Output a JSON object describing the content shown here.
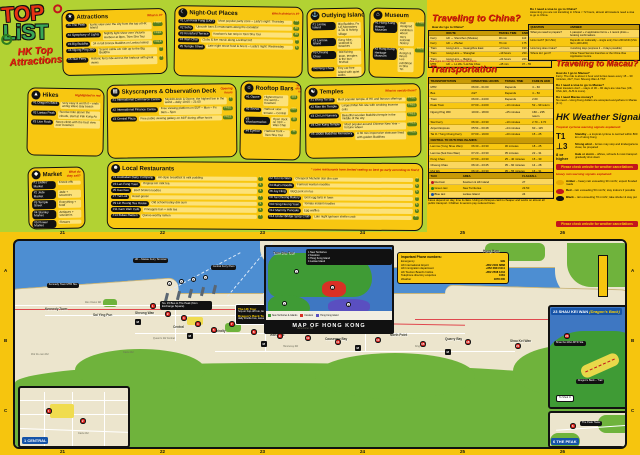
{
  "logo": {
    "line1": "TOP",
    "line2": "LiST",
    "sub1": "HK Top",
    "sub2": "Attractions"
  },
  "categories": [
    {
      "id": "attractions",
      "icon": "★",
      "title": "Attractions",
      "subtitle": "What is it?",
      "items": [
        {
          "name": "The Peak",
          "desc": "Iconic view over the city from the top of HK Island",
          "tag": "FREE"
        },
        {
          "name": "Symphony of Lights",
          "desc": "Nightly light show over Victoria Harbour at 8pm, Tsim Sha Tsui",
          "tag": "FREE"
        },
        {
          "name": "Big Buddha",
          "desc": "34 m tall bronze Buddha on Lantau Island",
          "tag": "FREE"
        },
        {
          "name": "Ngong Ping 360",
          "desc": "Scenic cable car ride up to the Big Buddha",
          "tag": "$"
        },
        {
          "name": "Star Ferry",
          "desc": "Historic ferry ride across the harbour with great views",
          "tag": "$"
        }
      ]
    },
    {
      "id": "nightout",
      "icon": "☾",
      "title": "Night-Out Places",
      "subtitle": "Which district is it?",
      "items": [
        {
          "name": "Lan Kwai Fong (LKF)",
          "desc": "Most popular party zone – Lady's night: Thursday",
          "tag": "$$"
        },
        {
          "name": "Soho",
          "desc": "Upscale bars & restaurants along the escalator",
          "tag": "$$"
        },
        {
          "name": "Knutsford Terrace",
          "desc": "Kowloon's bar strip in Tsim Sha Tsui",
          "tag": "$$"
        },
        {
          "name": "Wan Chai",
          "desc": "Clubs & live music along Lockhart Rd",
          "tag": "$"
        },
        {
          "name": "Temple Street",
          "desc": "Late night street food & beers – Lady's night: Wednesday",
          "tag": "$"
        }
      ]
    },
    {
      "id": "islands",
      "icon": "⚓",
      "title": "Outlying Islands",
      "subtitle": "What to see there?",
      "items": [
        {
          "name": "Lantau Island",
          "desc": "Big Buddha, Po Lin Monastery & Tai O fishing village"
        },
        {
          "name": "Lamma Island",
          "desc": "Easy hike, seafood & beaches"
        },
        {
          "name": "Cheung Chau",
          "desc": "Old fishing town, temples & the bun festival"
        },
        {
          "name": "Peng Chau",
          "desc": "Tiny car-free island with quiet walks"
        }
      ]
    },
    {
      "id": "museum",
      "icon": "⌂",
      "title": "Museum",
      "subtitle": "",
      "items": [
        {
          "name": "Hong Kong History Museum",
          "desc": "Well designed exhibition about HK's colonial history",
          "tag": "FREE on Wed"
        },
        {
          "name": "Hong Kong Heritage Museum",
          "desc": "Art, design & Bruce Lee exhibition in Sha Tin",
          "tag": "FREE on Wed"
        }
      ]
    },
    {
      "id": "hikes",
      "icon": "▲",
      "title": "Hikes",
      "subtitle": "Highlighted in red",
      "items": [
        {
          "name": "Dragon's Back",
          "desc": "Very easy & worth it – ends at Big Wave Bay beach"
        },
        {
          "name": "Lantau Peak",
          "desc": "Sunrise hike above the clouds, start at Pak Kung Au"
        },
        {
          "name": "Lion Rock",
          "desc": "Steep climb with the best view over Kowloon"
        }
      ]
    },
    {
      "id": "sky",
      "icon": "▦",
      "title": "Skyscrapers & Observation Deck",
      "subtitle": "Opening hours",
      "items": [
        {
          "name": "International Commerce Centre",
          "desc": "Sky100 deck & Ozone, the highest bar in the world – daily 10:00 – 21:00",
          "tag": "$"
        },
        {
          "name": "International Finance Centre",
          "desc": "Free viewing platform on 55/F – Mon – Fri 9am – 5pm",
          "tag": "FREE"
        },
        {
          "name": "Central Plaza",
          "desc": "Free public viewing gallery on 46/F during office hours",
          "tag": "FREE"
        }
      ]
    },
    {
      "id": "rooftop",
      "icon": "☼",
      "title": "Rooftop Bars",
      "subtitle": "Which district is it?",
      "items": [
        {
          "name": "Ozone",
          "desc": "Highest bar in the world – Kowloon",
          "tag": "$$$"
        },
        {
          "name": "Sevva",
          "desc": "Harbour view terrace – Central",
          "tag": "$$$"
        },
        {
          "name": "Wooloomooloo",
          "desc": "Open deck on 31/F – Wan Chai",
          "tag": "$$"
        },
        {
          "name": "Eyebar",
          "desc": "Harbour front – Tsim Sha Tsui",
          "tag": "$$"
        }
      ]
    },
    {
      "id": "temples",
      "icon": "☯",
      "title": "Temples",
      "subtitle": "What to see/do there?",
      "items": [
        {
          "name": "Wong Tai Sin",
          "desc": "Most popular temple of HK and famous offerings",
          "tag": "FREE"
        },
        {
          "name": "Man Mo Temple",
          "desc": "Largest Man Mo site with smoking incense coils",
          "tag": "FREE"
        },
        {
          "name": "Chi Lin Nunnery",
          "desc": "Beautiful wooden Buddhist temple in the middle of the city",
          "tag": "FREE"
        },
        {
          "name": "Che Kung Temple",
          "desc": "Most popular around Chinese New Year – fortune wheel",
          "tag": "FREE"
        },
        {
          "name": "10000 Buddhas Monastery",
          "desc": "A 30 min impressive staircase lined with golden Buddhas",
          "tag": "FREE"
        }
      ]
    },
    {
      "id": "market",
      "icon": "◆",
      "title": "Market",
      "subtitle": "What do they sell?",
      "items": [
        {
          "name": "Ladies' Market",
          "desc": "Knock-offs"
        },
        {
          "name": "Jade Market",
          "desc": "Jade + souvenirs"
        },
        {
          "name": "Temple Street",
          "desc": "Everything + food"
        },
        {
          "name": "Stanley Market",
          "desc": "Antiques + souvenirs"
        },
        {
          "name": "Flower Market",
          "desc": "Flowers"
        },
        {
          "name": "Goldfish Market",
          "desc": "Goldfishes + pet stuff"
        }
      ]
    },
    {
      "id": "food",
      "icon": "☻",
      "title": "Local Restaurants",
      "subtitle": "* some restaurants have limited seating so best go early according to find it",
      "two_col": true,
      "items": [
        {
          "name": "Australian Dairy Company",
          "desc": "HK-style breakfast & milk pudding",
          "tag": "$"
        },
        {
          "name": "Tim Ho Wan",
          "desc": "Cheapest Michelin star dim sum",
          "tag": "$"
        },
        {
          "name": "Lan Fong Yuen",
          "desc": "Original HK milk tea",
          "tag": "$"
        },
        {
          "name": "Mak's Noodle",
          "desc": "Famous wonton noodles",
          "tag": "$"
        },
        {
          "name": "Kau Kee",
          "desc": "Beef brisket noodles",
          "tag": "$"
        },
        {
          "name": "Joy Hing",
          "desc": "BBQ pork on rice",
          "tag": "$"
        },
        {
          "name": "Yat Lok",
          "desc": "Roast goose",
          "tag": "$"
        },
        {
          "name": "Tai Cheong Bakery",
          "desc": "Best egg tarts in town",
          "tag": "$"
        },
        {
          "name": "Lin Heung Tea House",
          "desc": "Old school trolley dim sum",
          "tag": "$"
        },
        {
          "name": "Sing Heung Yuen",
          "desc": "Tomato instant noodles",
          "tag": "$"
        },
        {
          "name": "Kam Wah Café",
          "desc": "Pineapple bun + milk tea",
          "tag": "$"
        },
        {
          "name": "Mammy Pancake",
          "desc": "Egg waffles",
          "tag": "$"
        },
        {
          "name": "Butao Ramen",
          "desc": "Queue-worthy ramen",
          "tag": "$"
        },
        {
          "name": "Under Bridge Spicy Crab",
          "desc": "Late night typhoon shelter crab",
          "tag": "$$"
        }
      ]
    }
  ],
  "china": {
    "title": "Traveling to China?",
    "lead": "How do I go to China?",
    "table_headers": [
      "",
      "ROUTE",
      "TRAVEL TIME",
      "FARE IN HKD"
    ],
    "rows": [
      [
        "Ferry",
        "HK ↔ Shenzhen (Shekou)",
        "30 min",
        "110"
      ],
      [
        "Ferry",
        "HK ↔ Zhuhai",
        "70 min",
        "175"
      ],
      [
        "Train",
        "Hung Hom ↔ Guangzhou East",
        "~2 hours",
        "190 – 230"
      ],
      [
        "Train",
        "Hung Hom ↔ Shanghai",
        "~19 hours",
        "230 – 1,039"
      ],
      [
        "Train",
        "Hung Hom ↔ Beijing",
        "~24 hours",
        "240 – 1,191"
      ],
      [
        "MTR",
        "HK ↔ Lo Wu / Lok Ma Chau",
        "~45 min",
        "37 – 55"
      ]
    ],
    "footnote": "* See signs on map for traveling directions",
    "visa_q": "Do I need a visa to go to China?",
    "visa_a": "Assuming you are not transiting in China < 72 hours, almost all travelers need a visa to go to China.",
    "qa_headers": [
      "QUESTION",
      "ANSWER"
    ],
    "qa": [
      [
        "What you need to prepare?",
        "1 passport + 2 application forms + 1 recent photo + booking confirmations"
      ],
      [
        "How much? (for USA)",
        "Depends on nationality – single entry from 200 HKD (USA flat 1,100 HKD)"
      ],
      [
        "How long does it take?",
        "4 working days (express 2 – 3 days possible)"
      ],
      [
        "Where do I get it?",
        "China Travel Service branches or the China Visa Application Centre"
      ]
    ]
  },
  "transport": {
    "title": "Transportation",
    "headers": [
      "TRANSPORTATION",
      "OPERATING HOURS",
      "TRAVEL TIME",
      "FARE IN HKD"
    ],
    "rows": [
      [
        "MTR",
        "06:00 – 01:00",
        "Depends",
        "4 – 60"
      ],
      [
        "Bus",
        "24/7",
        "Depends",
        "4 – 50"
      ],
      [
        "Tram",
        "06:00 – 24:00",
        "Depends",
        "2.60"
      ],
      [
        "Peak Tram",
        "07:00 – 24:00",
        "~10 minutes",
        "52 – 99 return"
      ],
      [
        "Ngong Ping 360",
        "10:00 – 18:00",
        "~25 minutes",
        "160 – 235 return"
      ],
      [
        "Star Ferry",
        "06:30 – 23:30",
        "~10 minutes",
        "2.70 – 3.70"
      ],
      [
        "Airport Express",
        "05:54 – 00:48",
        "~24 minutes",
        "60 – 115"
      ],
      [
        "Tai O / Tung Chung Ferry",
        "07:00 – 19:00",
        "~20 minutes",
        "15 – 25"
      ]
    ],
    "subheader": "CENTRAL TO OUTLYING ISLANDS:",
    "island_rows": [
      [
        "Lamma (Yung Shue Wan)",
        "06:30 – 23:30",
        "30 minutes",
        "18 – 25"
      ],
      [
        "Lamma (Sok Kwu Wan)",
        "07:20 – 23:30",
        "35 minutes",
        "22 – 31"
      ],
      [
        "Peng Chau",
        "07:00 – 23:30",
        "25 – 40 minutes",
        "15 – 30"
      ],
      [
        "Cheung Chau",
        "06:10 – 23:45",
        "35 – 60 minutes",
        "14 – 28"
      ],
      [
        "Mui Wo",
        "06:10 – 23:30",
        "35 – 55 minutes",
        "16 – 31"
      ]
    ],
    "taxi_headers": [
      "TAXI",
      "AREA",
      "FLAGFALL"
    ],
    "taxi_rows": [
      {
        "label": "Red taxi",
        "area": "Kowloon & HK Island",
        "fare": "27",
        "color": "#c3151c"
      },
      {
        "label": "Green taxi",
        "area": "New Territories",
        "fare": "23.50",
        "color": "#2d7d1f"
      },
      {
        "label": "Blue taxi",
        "area": "Lantau Island",
        "fare": "24",
        "color": "#1553a8"
      }
    ],
    "note": "Fares depend on day, time & class. Using an Octopus card is cheaper and works on almost all public transport. Children & seniors pay reduced fares."
  },
  "macau": {
    "title": "Traveling to Macau?",
    "qa": [
      [
        "How do I go to Macau?",
        "Ferry. The ride is about 1 hour and ferries leave every 15 – 30 minutes, 24/7, from Sheung Wan & TST."
      ],
      [
        "Do I need a visa to go to Macau?",
        "Most travelers don't – stays of 30 – 90 days are visa free (UK, USA, EU, AUS & more)."
      ],
      [
        "Do I need Macau money?",
        "No need – Hong Kong dollars are accepted everywhere in Macau (1:1)."
      ]
    ]
  },
  "weather": {
    "title": "HK Weather Signals",
    "cyclone_sub": "Tropical cyclone warning signals explained:",
    "signals": [
      {
        "glyph": "T1",
        "small": false,
        "label": "Standby",
        "desc": "– a tropical cyclone is centred within 800 km of Hong Kong"
      },
      {
        "glyph": "⊥3",
        "small": false,
        "label": "Strong wind",
        "desc": "– ferries may stop and kindergartens close; be prepared"
      },
      {
        "glyph": "8 or higher",
        "small": true,
        "label": "Gale or storm",
        "desc": "– offices, schools & most transport gradually shut down"
      }
    ],
    "banner": "Please check website for weather cancellations",
    "rain_sub": "Heavy rain warning signals explained:",
    "rain": [
      {
        "color": "#e8a800",
        "name": "Amber",
        "desc": "– heavy rain exceeding 30 mm/hr; expect flooded roads"
      },
      {
        "color": "#c3151c",
        "name": "Red",
        "desc": "– rain exceeding 50 mm/hr; stay indoors if possible"
      },
      {
        "color": "#111111",
        "name": "Black",
        "desc": "– rain exceeding 70 mm/hr; take shelter & stay put"
      }
    ]
  },
  "map": {
    "inset_title": "MAP OF HONG KONG",
    "inset_info": [
      "1  New Territories",
      "2  Kowloon",
      "3  Hong Kong Island",
      "4  Lantau Island"
    ],
    "legend": [
      {
        "color": "#3f9b35",
        "label": "New Territories & Islands"
      },
      {
        "color": "#d93025",
        "label": "Kowloon"
      },
      {
        "color": "#5a4fc0",
        "label": "Hong Kong Island"
      }
    ],
    "phone": {
      "title": "Important Phone numbers:",
      "rows": [
        [
          "Emergency",
          "999"
        ],
        [
          "HK International Airport",
          "+852 2181 8888"
        ],
        [
          "HK Immigration department",
          "+852 2824 6111"
        ],
        [
          "HK Tourism Board's hotline",
          "+852 2508 1234"
        ],
        [
          "Telephone directory enquiries",
          "1081"
        ],
        [
          "Weather",
          "1878 200"
        ]
      ]
    },
    "callouts": {
      "bus": "No. 15 Bus to The Peak (from Exchange Square)",
      "tour1_title": "The HK Tour",
      "tour1_text": "hop-on hop-off bus, leaves Tsim Sha Tsui",
      "tour2_title": "Dragon's Back Tour",
      "tour2_text": "daily shuttle bus, leaves Shau Kei Wan"
    },
    "labels": {
      "kennedy": "Kennedy Town MTR Sta.",
      "ferry_terminal": "HK – Macau Ferry Terminal",
      "piers": "Central Ferry Piers"
    },
    "districts": [
      {
        "name": "Kennedy Town",
        "x": 30,
        "y": 66
      },
      {
        "name": "Sai Ying Pun",
        "x": 78,
        "y": 72
      },
      {
        "name": "Sheung Wan",
        "x": 120,
        "y": 70
      },
      {
        "name": "Central",
        "x": 158,
        "y": 84
      },
      {
        "name": "Admiralty",
        "x": 196,
        "y": 88
      },
      {
        "name": "Wan Chai",
        "x": 255,
        "y": 92
      },
      {
        "name": "Causeway Bay",
        "x": 310,
        "y": 96
      },
      {
        "name": "North Point",
        "x": 375,
        "y": 92
      },
      {
        "name": "Quarry Bay",
        "x": 430,
        "y": 96
      },
      {
        "name": "Shau Kei Wan",
        "x": 495,
        "y": 98
      },
      {
        "name": "Tsim Sha Tsui",
        "x": 258,
        "y": 10
      },
      {
        "name": "Hung Hom",
        "x": 468,
        "y": 8
      }
    ],
    "streets": [
      {
        "name": "Des Voeux Rd",
        "x": 70,
        "y": 60
      },
      {
        "name": "Queen's Rd Central",
        "x": 138,
        "y": 96
      },
      {
        "name": "Caine Rd",
        "x": 108,
        "y": 110
      },
      {
        "name": "Hennessy Rd",
        "x": 268,
        "y": 104
      },
      {
        "name": "Gloucester Rd",
        "x": 282,
        "y": 86
      },
      {
        "name": "King's Rd",
        "x": 400,
        "y": 104
      },
      {
        "name": "Pok Fu Lam Rd",
        "x": 16,
        "y": 112
      }
    ],
    "markers": [
      {
        "n": "1",
        "x": 135,
        "y": 62,
        "t": "r"
      },
      {
        "n": "2",
        "x": 150,
        "y": 70,
        "t": "r"
      },
      {
        "n": "3",
        "x": 166,
        "y": 74,
        "t": "r"
      },
      {
        "n": "4",
        "x": 180,
        "y": 80,
        "t": "r"
      },
      {
        "n": "5",
        "x": 196,
        "y": 86,
        "t": "r"
      },
      {
        "n": "7",
        "x": 214,
        "y": 80,
        "t": "r"
      },
      {
        "n": "8",
        "x": 236,
        "y": 88,
        "t": "r"
      },
      {
        "n": "9",
        "x": 262,
        "y": 92,
        "t": "r"
      },
      {
        "n": "10",
        "x": 290,
        "y": 94,
        "t": "r"
      },
      {
        "n": "11",
        "x": 320,
        "y": 98,
        "t": "r"
      },
      {
        "n": "13",
        "x": 360,
        "y": 96,
        "t": "r"
      },
      {
        "n": "15",
        "x": 405,
        "y": 100,
        "t": "r"
      },
      {
        "n": "18",
        "x": 450,
        "y": 98,
        "t": "r"
      },
      {
        "n": "21",
        "x": 500,
        "y": 102,
        "t": "r"
      },
      {
        "n": "M",
        "x": 120,
        "y": 78,
        "t": "b"
      },
      {
        "n": "M",
        "x": 172,
        "y": 92,
        "t": "b"
      },
      {
        "n": "M",
        "x": 246,
        "y": 100,
        "t": "b"
      },
      {
        "n": "M",
        "x": 340,
        "y": 104,
        "t": "b"
      },
      {
        "n": "M",
        "x": 430,
        "y": 108,
        "t": "b"
      }
    ],
    "pier_nums": [
      "4",
      "5",
      "6",
      "7"
    ],
    "grid": {
      "top": [
        "21",
        "22",
        "23",
        "24",
        "25",
        "26"
      ],
      "left": [
        "A",
        "B",
        "C"
      ]
    },
    "insets": {
      "dragons_back": {
        "num": "23",
        "name": "SHAU KEI WAN",
        "sub": "(Dragon's Back)",
        "trail": "Dragon's Back – Trail",
        "to": "To Shek O",
        "station": "Shau Kei Wan MTR Sta.",
        "marker": "23"
      },
      "peak": {
        "num": "6",
        "name": "THE PEAK",
        "chip": "The Peak Tower",
        "marker": "6"
      },
      "central": {
        "num": "1",
        "name": "CENTRAL",
        "street": "Caine Rd",
        "m1": "1",
        "m2": "2"
      }
    }
  }
}
